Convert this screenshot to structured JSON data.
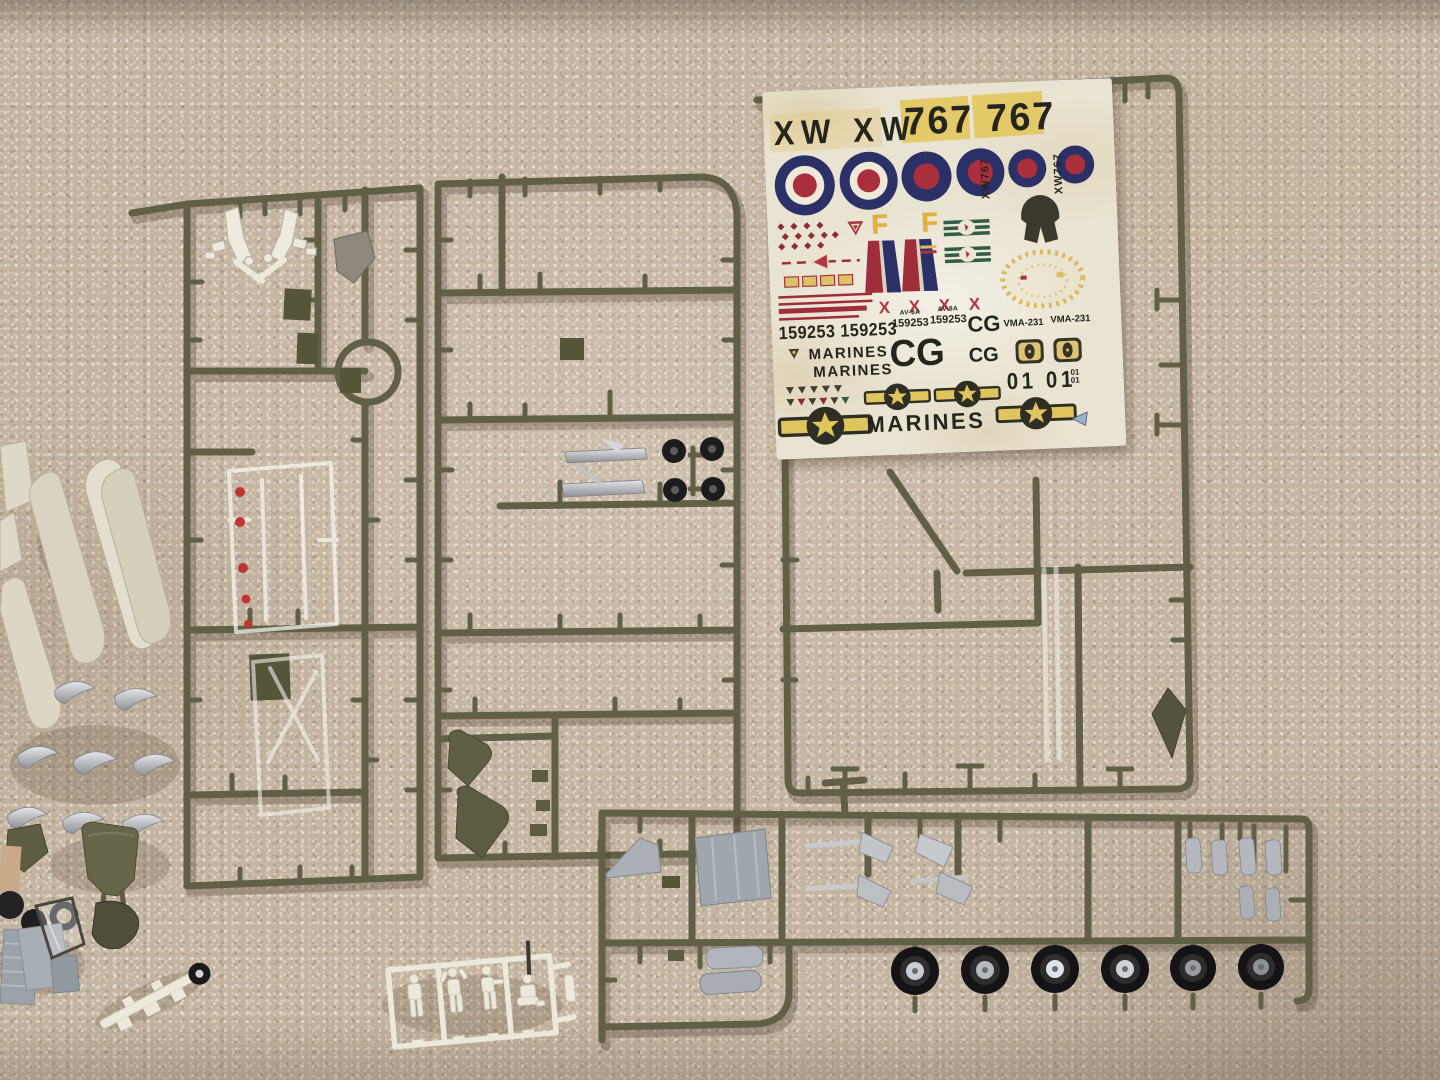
{
  "scene": {
    "description": "Photograph of a 1/48 AV-8A Harrier model kit: olive-drab sprues, white crew-figure sprue, loose painted parts and a MARINES decal sheet laid out on beige carpet"
  },
  "colors": {
    "carpet": "#c4b5a0",
    "sprue_olive": "#615f46",
    "decal_paper": "#e9e3d1",
    "roundel_navy": "#2b3166",
    "decal_red": "#a93240",
    "decal_maroon": "#9e2f3a",
    "decal_yellow": "#e0c45e",
    "decal_green": "#335c44",
    "ink_black": "#25241d",
    "silver_paint": "#c6c8cc",
    "white_plastic": "#ece8da",
    "tire_black": "#1c1c1e",
    "cream_part": "#dcd6c2",
    "gray_part": "#9fa6ad"
  },
  "decal": {
    "xw": "XW XW",
    "serial": "767 767",
    "f": "F F",
    "xw767": [
      "XW767",
      "XW767"
    ],
    "x_row": "X X X X",
    "serial_big": "159253 159253",
    "av8a": "AV-8A",
    "serial_small": [
      "159253",
      "159253"
    ],
    "cg": [
      "CG",
      "CG",
      "CG"
    ],
    "vma": [
      "VMA-231",
      "VMA-231"
    ],
    "marines": [
      "MARINES",
      "MARINES",
      "MARINES"
    ],
    "zero_one": "01 01",
    "zero_one_small": [
      "01",
      "01"
    ]
  }
}
